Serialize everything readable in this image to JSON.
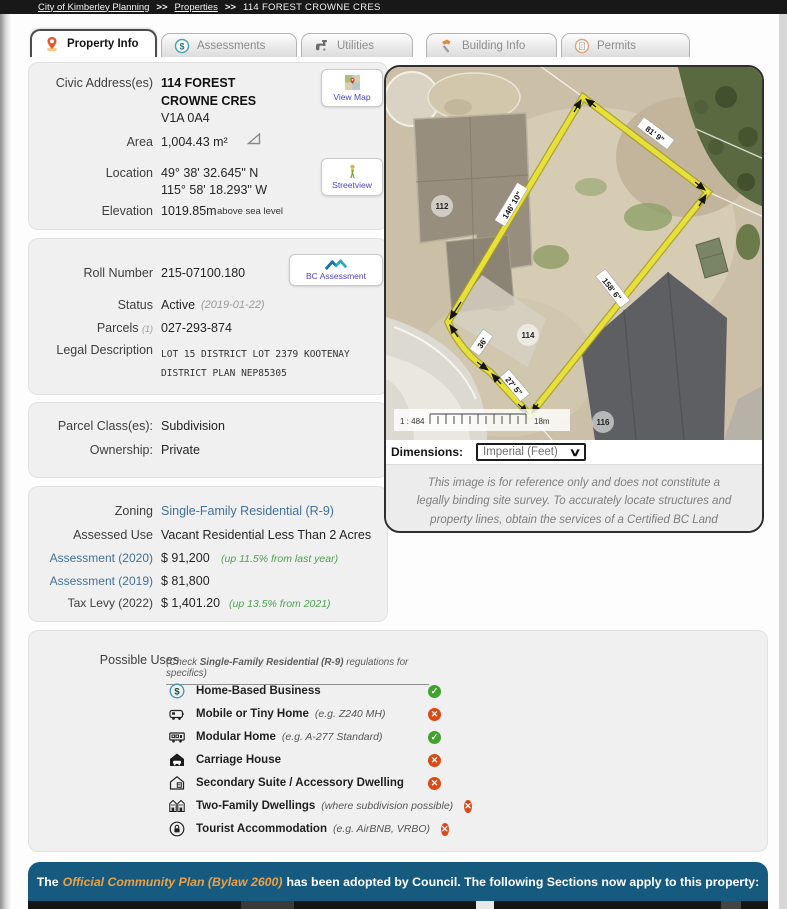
{
  "breadcrumb": {
    "items": [
      "City of Kimberley Planning",
      "Properties",
      "114 FOREST CROWNE CRES"
    ],
    "separator": ">>"
  },
  "tabs": [
    {
      "label": "Property Info",
      "active": true
    },
    {
      "label": "Assessments",
      "active": false
    },
    {
      "label": "Utilities",
      "active": false
    },
    {
      "label": "Building Info",
      "active": false
    },
    {
      "label": "Permits",
      "active": false
    }
  ],
  "address": {
    "civic_label": "Civic Address(es)",
    "line1": "114 FOREST CROWNE CRES",
    "postal": "V1A 0A4",
    "area_label": "Area",
    "area_value": "1,004.43 m²",
    "location_label": "Location",
    "lat": "49° 38' 32.645\" N",
    "lon": "115° 58' 18.293\" W",
    "elevation_label": "Elevation",
    "elevation_value": "1019.85m",
    "elevation_suffix": "above sea level",
    "view_map_label": "View Map",
    "streetview_label": "Streetview"
  },
  "roll": {
    "roll_label": "Roll Number",
    "roll_value": "215-07100.180",
    "status_label": "Status",
    "status_value": "Active",
    "status_date": "(2019-01-22)",
    "parcels_label": "Parcels",
    "parcels_count": "(1)",
    "parcels_value": "027-293-874",
    "legal_label": "Legal Description",
    "legal_value": "LOT 15 DISTRICT LOT 2379 KOOTENAY DISTRICT PLAN NEP85305",
    "bc_assessment_label": "BC Assessment"
  },
  "parcel": {
    "class_label": "Parcel Class(es):",
    "class_value": "Subdivision",
    "ownership_label": "Ownership:",
    "ownership_value": "Private"
  },
  "zoning": {
    "zoning_label": "Zoning",
    "zoning_value": "Single-Family Residential (R-9)",
    "assessed_label": "Assessed Use",
    "assessed_value": "Vacant Residential Less Than 2 Acres",
    "a2020_label": "Assessment (2020)",
    "a2020_value": "$ 91,200",
    "a2020_note": "(up 11.5% from last year)",
    "a2019_label": "Assessment (2019)",
    "a2019_value": "$ 81,800",
    "tax_label": "Tax Levy (2022)",
    "tax_value": "$ 1,401.20",
    "tax_note": "(up 13.5% from 2021)"
  },
  "uses": {
    "title": "Possible Uses",
    "note_prefix": "(Check ",
    "note_zone": "Single-Family Residential (R-9)",
    "note_suffix": " regulations for specifics)",
    "items": [
      {
        "label": "Home-Based Business",
        "note": "",
        "allowed": true
      },
      {
        "label": "Mobile or Tiny Home",
        "note": "(e.g. Z240 MH)",
        "allowed": false
      },
      {
        "label": "Modular Home",
        "note": "(e.g. A-277 Standard)",
        "allowed": true
      },
      {
        "label": "Carriage House",
        "note": "",
        "allowed": false
      },
      {
        "label": "Secondary Suite / Accessory Dwelling",
        "note": "",
        "allowed": false
      },
      {
        "label": "Two-Family Dwellings",
        "note": "(where subdivision possible)",
        "allowed": false
      },
      {
        "label": "Tourist Accommodation",
        "note": "(e.g. AirBNB, VRBO)",
        "allowed": false
      }
    ]
  },
  "map": {
    "dimensions_label": "Dimensions:",
    "dimensions_value": "Imperial (Feet)",
    "scale_ratio": "1 : 484",
    "scale_distance": "18m",
    "edge_labels": [
      "81' 9\"",
      "146' 10\"",
      "158' 6\"",
      "36'",
      "27' 5\""
    ],
    "lot_numbers": [
      "112",
      "114",
      "116"
    ],
    "disclaimer": "This image is for reference only and does not constitute a legally binding site survey. To accurately locate structures and property lines, obtain the services of a Certified BC Land Surveyor"
  },
  "banner": {
    "prefix": "The",
    "link": "Official Community Plan (Bylaw 2600)",
    "suffix": "has been adopted by Council. The following Sections now apply to this property:"
  }
}
